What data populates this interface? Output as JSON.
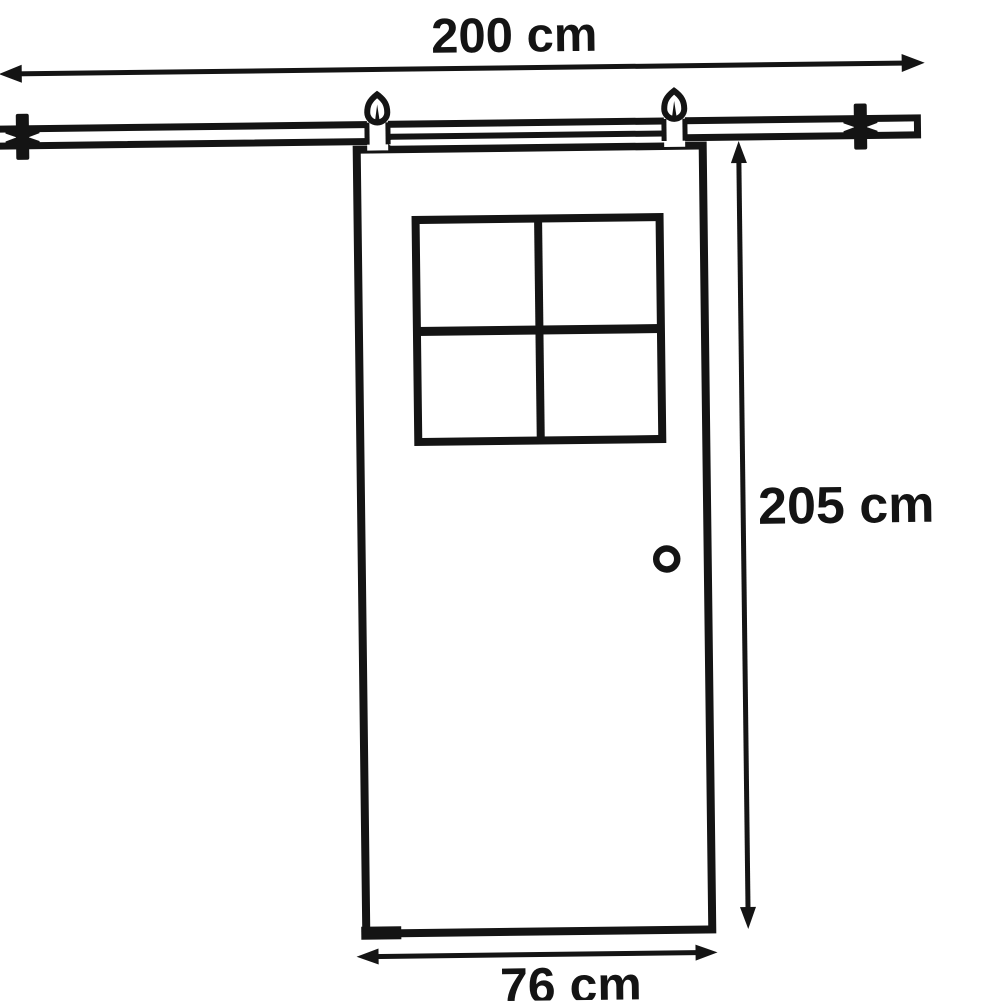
{
  "diagram": {
    "type": "technical-dimension-drawing",
    "subject": "sliding barn door with hanging track",
    "background_color": "#ffffff",
    "line_color": "#141414",
    "dimensions": {
      "track_width": {
        "label": "200 cm"
      },
      "door_height": {
        "label": "205 cm"
      },
      "door_width": {
        "label": "76 cm"
      }
    },
    "components": [
      "sliding-track-rail",
      "left-wall-bracket",
      "right-wall-bracket",
      "left-roller-hanger",
      "right-roller-hanger",
      "door-top-mounting-bar",
      "door-panel",
      "four-pane-window",
      "round-door-knob",
      "bottom-floor-guide-step"
    ]
  }
}
